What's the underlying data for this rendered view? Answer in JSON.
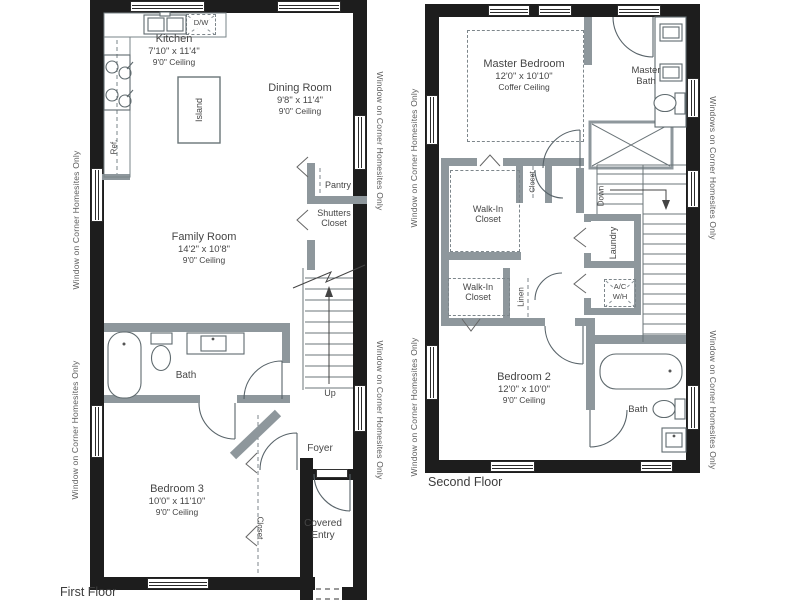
{
  "colors": {
    "wall": "#1d1d1d",
    "partition": "#8e979c",
    "linework": "#6a7478",
    "text": "#464646"
  },
  "ff": {
    "caption": "First Floor",
    "kitchen": {
      "name": "Kitchen",
      "dims": "7'10\" x 11'4\"",
      "ceil": "9'0\" Ceiling"
    },
    "dining": {
      "name": "Dining Room",
      "dims": "9'8\" x 11'4\"",
      "ceil": "9'0\" Ceiling"
    },
    "family": {
      "name": "Family Room",
      "dims": "14'2\" x 10'8\"",
      "ceil": "9'0\" Ceiling"
    },
    "bed3": {
      "name": "Bedroom 3",
      "dims": "10'0\" x 11'10\"",
      "ceil": "9'0\" Ceiling"
    },
    "bath": "Bath",
    "foyer": "Foyer",
    "entry": "Covered Entry",
    "pantry": "Pantry",
    "shutters": "Shutters Closet",
    "closet": "Closet",
    "island": "Island",
    "dw": "D/W",
    "ref": "Ref.",
    "up": "Up"
  },
  "sf": {
    "caption": "Second Floor",
    "master": {
      "name": "Master Bedroom",
      "dims": "12'0\" x 10'10\"",
      "ceil": "Coffer Ceiling"
    },
    "bed2": {
      "name": "Bedroom 2",
      "dims": "12'0\" x 10'0\"",
      "ceil": "9'0\" Ceiling"
    },
    "master_bath": "Master Bath",
    "bath": "Bath",
    "wic_upper": "Walk-In Closet",
    "wic_lower": "Walk-In Closet",
    "laundry": "Laundry",
    "linen": "Linen",
    "closet": "Closet",
    "ac": "A/C",
    "wh": "W/H",
    "down": "Down"
  },
  "sides": {
    "ff_left_top": "Window on Corner Homesites Only",
    "ff_left_bottom": "Window on Corner Homesites Only",
    "ff_right_top": "Window on Corner Homesites Only",
    "ff_right_bottom": "Window on Corner Homesites Only",
    "sf_left_top": "Window on Corner Homesites Only",
    "sf_left_bottom": "Window on Corner Homesites Only",
    "sf_right_top": "Windows on Corner Homesites Only",
    "sf_right_bottom": "Window on Corner Homesites Only"
  }
}
